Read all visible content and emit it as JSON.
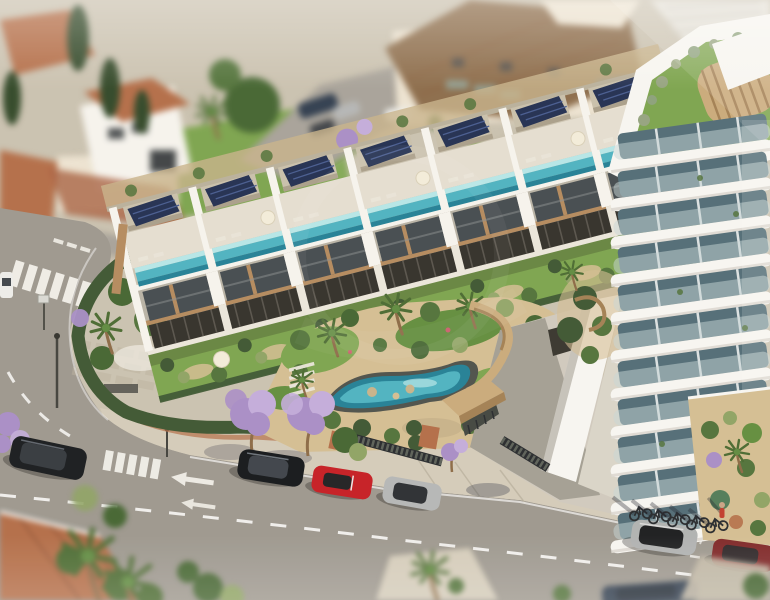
{
  "scene": {
    "description": "Aerial 3D architectural rendering of a modern townhouse development with rooftop lap pools and solar panels, a communal palm garden with lagoon pool, an entrance gate with timber canopy and a curved white residential tower, on a Mediterranean street corner with parked cars and jacaranda trees",
    "style": "photorealistic render with tilt-shift depth of field",
    "development": {
      "townhouse_units": 7,
      "rooftop_pools": 7,
      "solar_panels": 7,
      "communal_features": [
        "lagoon pool",
        "palm garden",
        "timber entrance canopy",
        "parking ramp",
        "perimeter hedge wall"
      ]
    },
    "tower": {
      "visible_floors": 11,
      "rooftop": "roof garden with lawn and round timber pavilion"
    },
    "street": {
      "crosswalks": 2,
      "lane_arrows": 2,
      "bicycles": 5,
      "jacaranda_trees": 3,
      "parked_cars": [
        {
          "name": "black-suv",
          "color": "#15181c"
        },
        {
          "name": "black-sedan",
          "color": "#101418"
        },
        {
          "name": "red-convertible",
          "color": "#c41a21"
        },
        {
          "name": "silver-hatchback",
          "color": "#b4b6b7"
        },
        {
          "name": "silver-car",
          "color": "#aeb1b2"
        },
        {
          "name": "dark-red-car",
          "color": "#7c2325"
        },
        {
          "name": "navy-car",
          "color": "#2c3a4d"
        },
        {
          "name": "blue-car-background",
          "color": "#3c6fa5"
        },
        {
          "name": "white-van",
          "color": "#ededea"
        }
      ]
    },
    "palette": {
      "ground": "#c9c1b0",
      "asphalt": "#9b968e",
      "asphaltLight": "#a6a199",
      "sidewalk": "#d3cbba",
      "sidewalkShade": "#c2b9a7",
      "paver": "#b9b19f",
      "marking": "#ffffff",
      "white": "#f6f4ef",
      "offwhite": "#eae6dc",
      "deck": "#e4ded1",
      "boxBeige": "#c8bfab",
      "boxSide": "#a89e89",
      "solar": "#1e2c50",
      "solarGrid": "#44598f",
      "poolTop": "#b5e6e8",
      "pool": "#4ab1c1",
      "poolDeep": "#1f7e95",
      "glazing": "#41484d",
      "wood": "#b3885c",
      "woodHi": "#cfa878",
      "pergola": "#2f2d27",
      "pergolaHi": "#55514a",
      "lawn": "#7aa34c",
      "lawnDark": "#5f8c3c",
      "hedge": "#3a5430",
      "shrub": "#4e7038",
      "olive": "#8da263",
      "palmGreen": "#47682f",
      "sand": "#d3bd92",
      "gravel": "#c7b189",
      "jac": "#a78cc7",
      "jacLight": "#c2abdc",
      "terra": "#b26b46",
      "terraDark": "#884f32",
      "roofBrown": "#8a6a49",
      "cream": "#ece3d2",
      "towerWhite": "#f7f6f3",
      "towerShade": "#dbd8d1",
      "glassDark": "#4e6a75",
      "balcony": "#c6d6d8",
      "timber": "#c9a97a",
      "timberSide": "#a17e52",
      "carBlack": "#15181c",
      "carSedan": "#101418",
      "carRed": "#c41a21",
      "carDarkRed": "#7c2325",
      "carSilver": "#b4b6b7",
      "carSilver2": "#aeb1b2",
      "carBlue": "#3c6fa5",
      "carNavy": "#2c3a4d",
      "vanWhite": "#ededea",
      "trunkBrown": "#8a6844",
      "fence": "#23262b",
      "gateDark": "#3f433e",
      "cypress": "#2e4526",
      "treeGreen": "#41632f"
    }
  }
}
